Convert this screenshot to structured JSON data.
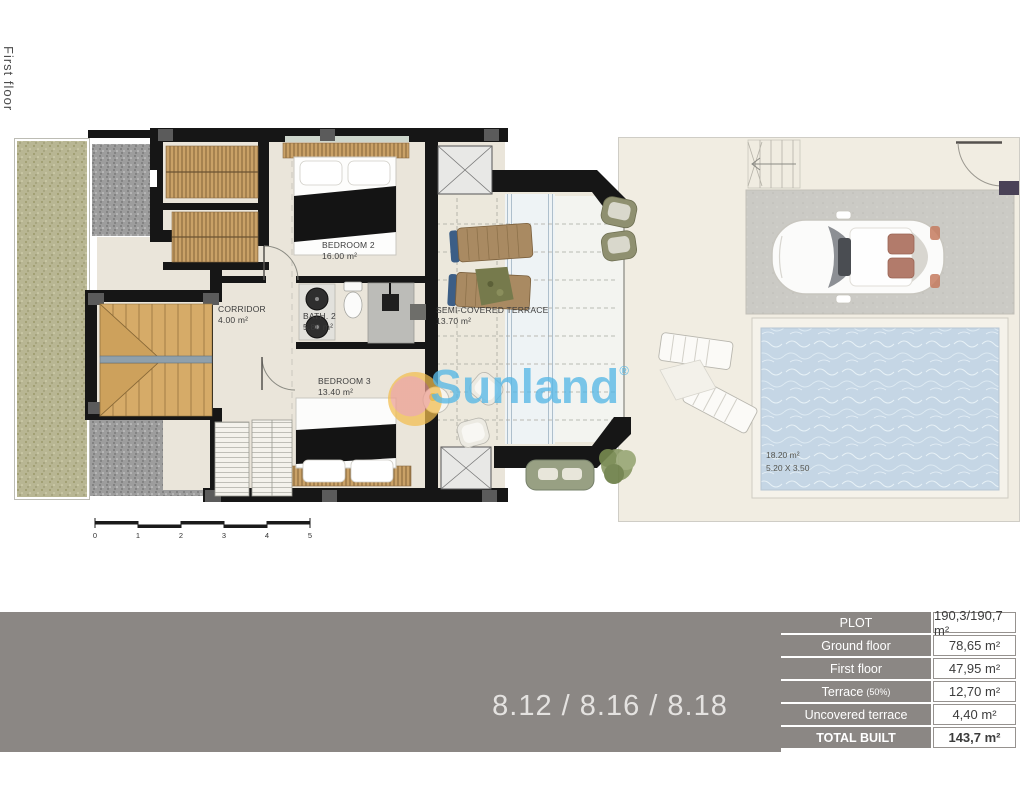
{
  "page": {
    "floor_label": "First floor"
  },
  "plan": {
    "rooms": [
      {
        "name": "BEDROOM 2",
        "area": "16.00 m²"
      },
      {
        "name": "CORRIDOR",
        "area": "4.00 m²"
      },
      {
        "name": "BATH. 2",
        "area": "5.80 m²"
      },
      {
        "name": "BEDROOM 3",
        "area": "13.40 m²"
      },
      {
        "name": "SEMI-COVERED TERRACE",
        "area": "13.70 m²"
      }
    ],
    "pool": {
      "area": "18.20 m²",
      "dimensions": "5.20 X 3.50"
    },
    "scale_bar": {
      "ticks": [
        "0",
        "1",
        "2",
        "3",
        "4",
        "5"
      ]
    }
  },
  "watermark": {
    "text": "Sunland",
    "registered": "®"
  },
  "footer": {
    "units_label": "8.12 / 8.16 / 8.18"
  },
  "summary_table": {
    "rows": [
      {
        "label": "PLOT",
        "value": "190,3/190,7 m²"
      },
      {
        "label": "Ground floor",
        "value": "78,65 m²"
      },
      {
        "label": "First floor",
        "value": "47,95 m²"
      },
      {
        "label": "Terrace",
        "label_suffix": "(50%)",
        "value": "12,70 m²"
      },
      {
        "label": "Uncovered terrace",
        "value": "4,40 m²"
      },
      {
        "label": "TOTAL BUILT",
        "value": "143,7 m²"
      }
    ]
  }
}
